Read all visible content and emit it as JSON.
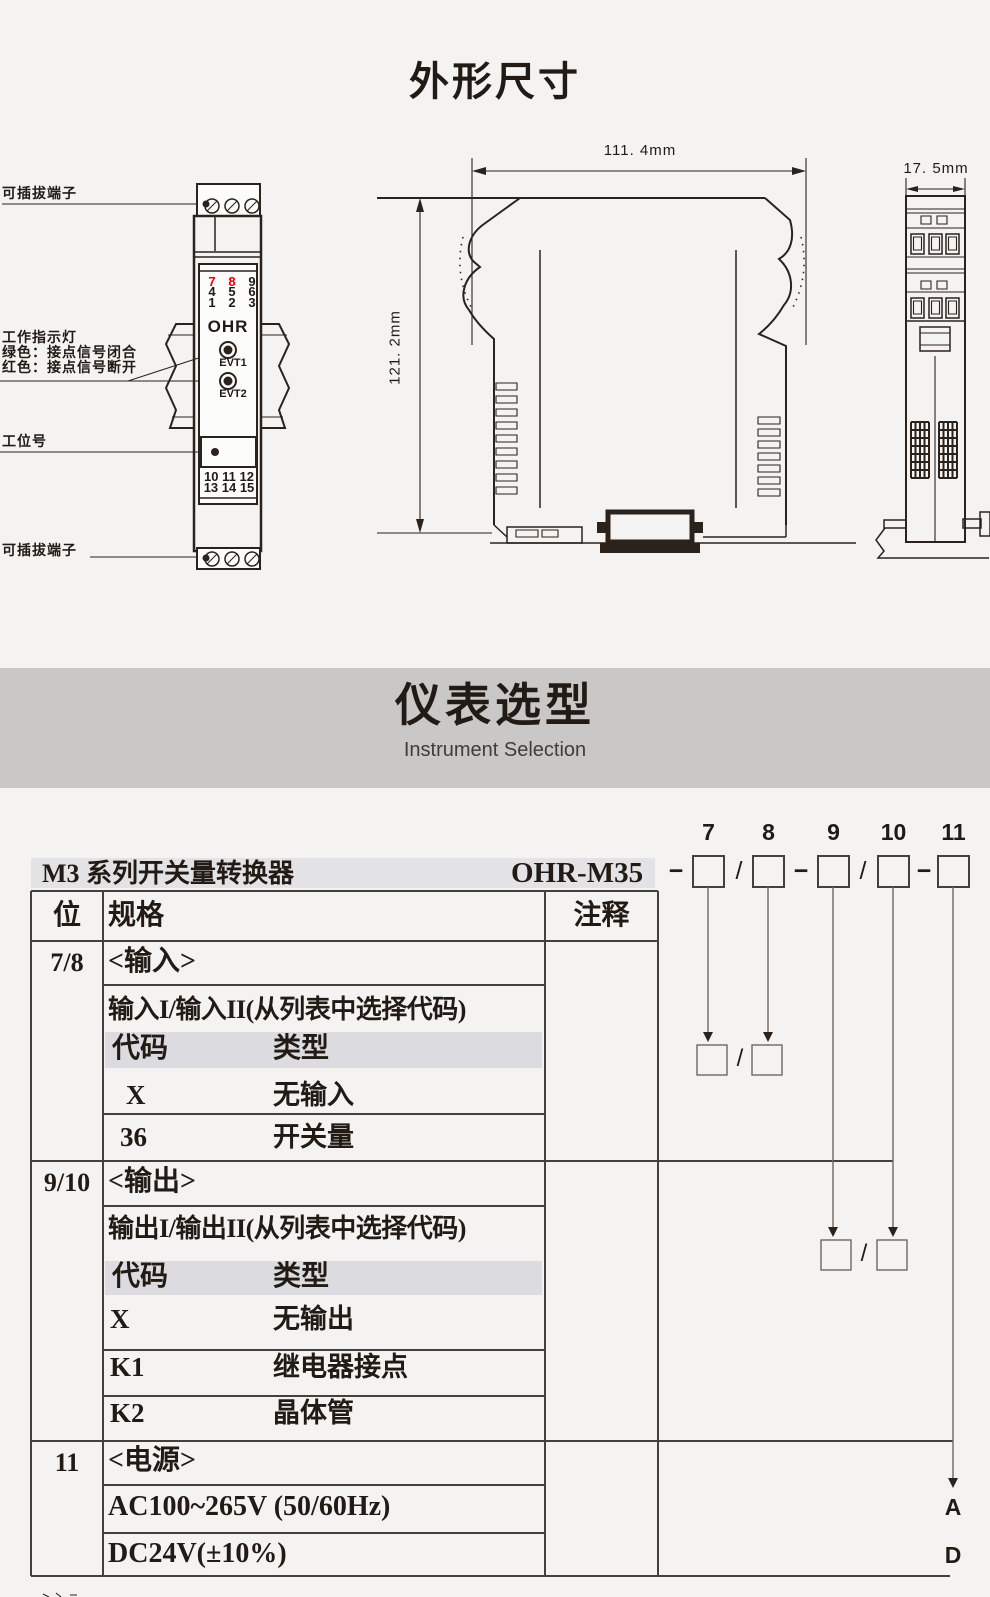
{
  "colors": {
    "accent_red": "#e60012",
    "ink": "#2b221c",
    "banner_bg": "#c9c8c6",
    "header_band_bg": "#e3e3e5",
    "code_band_bg": "#dcdce0"
  },
  "outline_section": {
    "title": "外形尺寸",
    "labels": {
      "plug_top": "可插拔端子",
      "indicator1": "工作指示灯",
      "indicator2": "绿色：接点信号闭合",
      "indicator3": "红色：接点信号断开",
      "station": "工位号",
      "plug_bottom": "可插拔端子"
    },
    "module": {
      "brand": "OHR",
      "top_terminal_numbers": [
        [
          "7",
          "8",
          "9"
        ],
        [
          "4",
          "5",
          "6"
        ],
        [
          "1",
          "2",
          "3"
        ]
      ],
      "red_numbers": [
        "7",
        "8"
      ],
      "led1": "EVT1",
      "led2": "EVT2",
      "bottom_terminal_rows": [
        "10 11 12",
        "13 14 15"
      ]
    },
    "dims": {
      "width": "111. 4mm",
      "height": "121. 2mm",
      "depth": "17. 5mm"
    }
  },
  "selection_section": {
    "banner_title": "仪表选型",
    "banner_subtitle": "Instrument Selection",
    "series": "M3 系列开关量转换器",
    "model": "OHR-M35",
    "dash": "−",
    "slash": "/",
    "digits": [
      "7",
      "8",
      "9",
      "10",
      "11"
    ],
    "table": {
      "headers": {
        "pos": "位",
        "spec": "规格",
        "note": "注释"
      },
      "sections": [
        {
          "pos": "7/8",
          "title": "<输入>",
          "subtitle": "输入I/输入II(从列表中选择代码)",
          "code_header": "代码",
          "type_header": "类型",
          "rows": [
            {
              "code": "X",
              "type": "无输入"
            },
            {
              "code": "36",
              "type": "开关量"
            }
          ]
        },
        {
          "pos": "9/10",
          "title": "<输出>",
          "subtitle": "输出I/输出II(从列表中选择代码)",
          "code_header": "代码",
          "type_header": "类型",
          "rows": [
            {
              "code": "X",
              "type": "无输出"
            },
            {
              "code": "K1",
              "type": "继电器接点"
            },
            {
              "code": "K2",
              "type": "晶体管"
            }
          ]
        },
        {
          "pos": "11",
          "title": "<电源>",
          "rows": [
            {
              "type": "AC100~265V (50/60Hz)",
              "suffix": "A"
            },
            {
              "type": "DC24V(±10%)",
              "suffix": "D"
            }
          ]
        }
      ]
    }
  }
}
